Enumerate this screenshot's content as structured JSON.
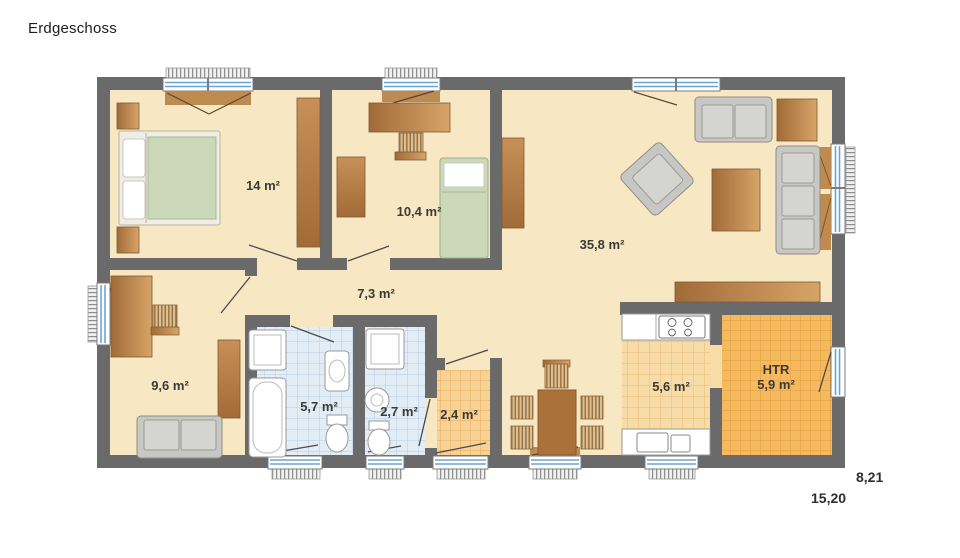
{
  "title": "Erdgeschoss",
  "dimensions": {
    "width": "15,20",
    "depth": "8,21"
  },
  "rooms": [
    {
      "id": "bedroom",
      "area": "14 m²"
    },
    {
      "id": "kids-room",
      "area": "10,4 m²"
    },
    {
      "id": "living-room",
      "area": "35,8 m²"
    },
    {
      "id": "hallway",
      "area": "7,3 m²"
    },
    {
      "id": "study",
      "area": "9,6 m²"
    },
    {
      "id": "bathroom",
      "area": "5,7 m²"
    },
    {
      "id": "wc",
      "area": "2,7 m²"
    },
    {
      "id": "entry",
      "area": "2,4 m²"
    },
    {
      "id": "kitchen",
      "area": "5,6 m²"
    },
    {
      "id": "htr",
      "name": "HTR",
      "area": "5,9 m²"
    }
  ],
  "colors": {
    "wall": "#6a6a6a",
    "floor": "#f8e7c3",
    "wood_dark": "#a16b38",
    "wood_light": "#d7a468",
    "tile_blue": "#e3edf6",
    "tile_orange": "#f6ba5e",
    "tile_kitchen": "#f8dca8",
    "mattress_green": "#ccd8ba",
    "sofa_gray": "#c7c7c4",
    "window_blue": "#6aa5cf"
  }
}
